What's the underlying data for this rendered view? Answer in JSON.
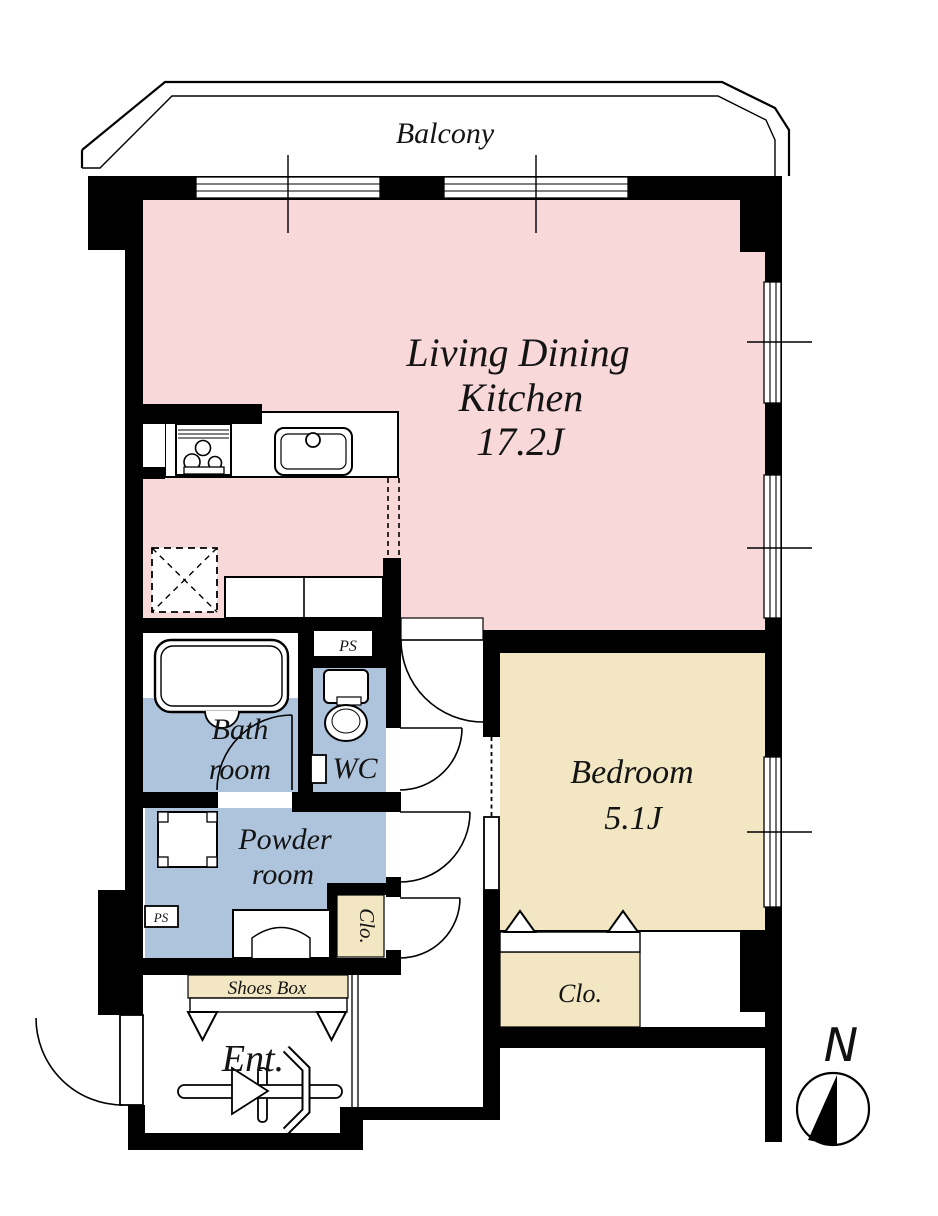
{
  "page": {
    "title": "Apartment floor plan",
    "type": "floor-plan"
  },
  "colors": {
    "ldk": "#f9d8da",
    "bedroom": "#f2e6c3",
    "wet_rooms": "#aec4dd",
    "closet": "#f2e6c3",
    "shoes_box": "#f2e6c3",
    "wall": "#000000",
    "background": "#ffffff"
  },
  "balcony": {
    "label": "Balcony"
  },
  "rooms": {
    "ldk": {
      "line1": "Living Dining",
      "line2": "Kitchen",
      "area": "17.2J"
    },
    "bedroom": {
      "label": "Bedroom",
      "area": "5.1J"
    },
    "bathroom": {
      "line1": "Bath",
      "line2": "room"
    },
    "wc": {
      "label": "WC"
    },
    "powder": {
      "line1": "Powder",
      "line2": "room"
    },
    "closet_hall": {
      "label": "Clo."
    },
    "closet_bedroom": {
      "label": "Clo."
    },
    "shoes_box": {
      "label": "Shoes Box"
    },
    "entrance": {
      "label": "Ent."
    },
    "pipe_space_top": {
      "label": "PS"
    },
    "pipe_space_bottom": {
      "label": "PS"
    }
  },
  "compass": {
    "label": "N"
  },
  "fixtures": [
    "kitchen-stove",
    "kitchen-sink",
    "refrigerator-space",
    "kitchen-cabinet",
    "bathtub",
    "toilet",
    "toilet-paper-holder",
    "washing-machine-pan",
    "vanity-sink",
    "entrance-door-symbol",
    "sliding-door",
    "hinged-doors",
    "windows"
  ]
}
